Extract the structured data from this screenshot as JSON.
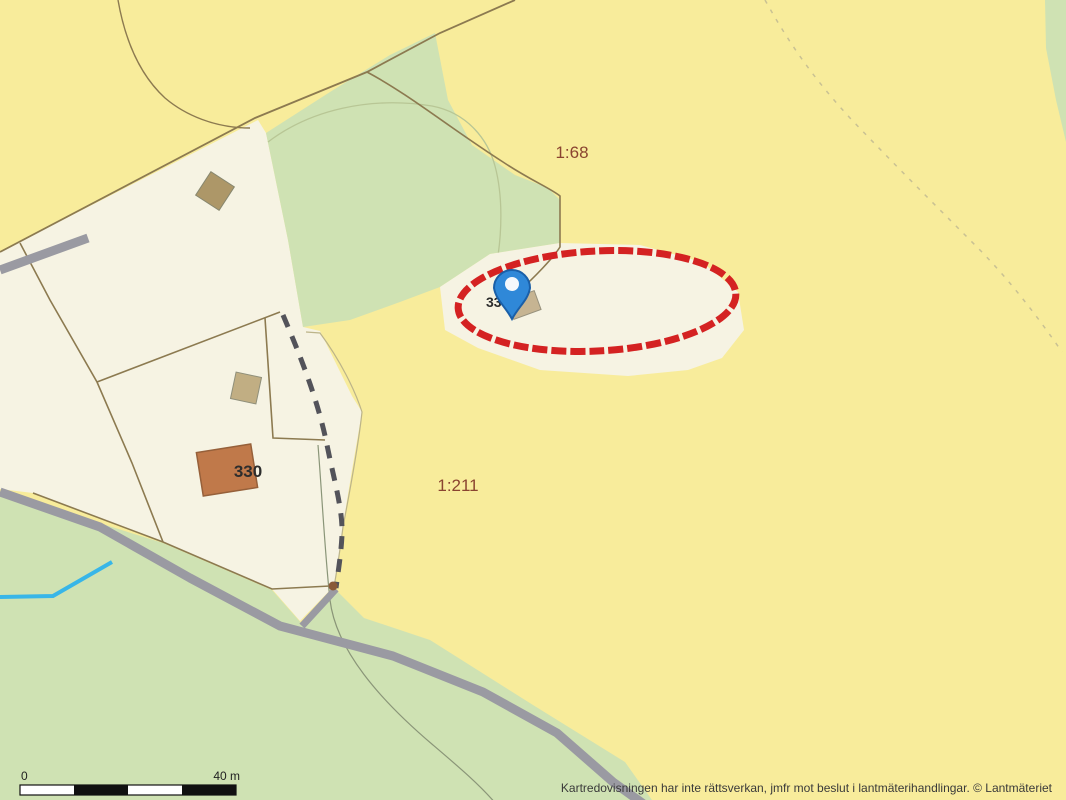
{
  "map": {
    "labels": {
      "parcel_1_68": "1:68",
      "parcel_1_211": "1:211",
      "building_330": "330",
      "building_33_partial": "33"
    },
    "scale_bar": {
      "start_label": "0",
      "end_label": "40 m"
    },
    "attribution": "Kartredovisningen har inte rättsverkan, jmfr mot beslut i lantmäterihandlingar. © Lantmäteriet",
    "colors": {
      "open_land_yellow": "#f8ec9b",
      "forest_green": "#cfe2b3",
      "parcel_white": "#f6f3e3",
      "road_gray": "#9a9aa2",
      "boundary_brown": "#8c7a50",
      "parcel_label_brown": "#8a4430",
      "annotation_red": "#d42222",
      "marker_blue": "#2f88d8",
      "marker_blue_dark": "#1a5fa8",
      "stream_cyan": "#38b6e8",
      "building_brown": "#c0794a",
      "building_tan": "#ad9768"
    }
  }
}
